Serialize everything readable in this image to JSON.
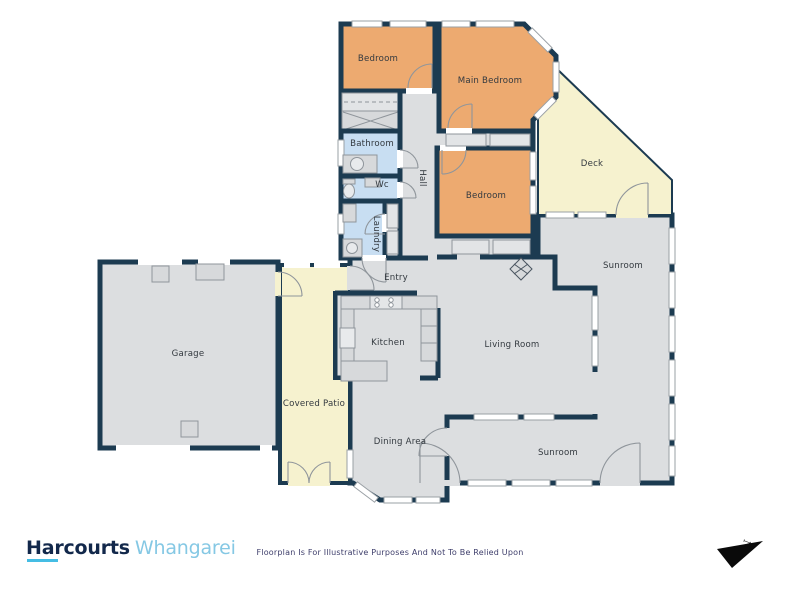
{
  "branding": {
    "brand": "Harcourts",
    "office": "Whangarei",
    "brand_color": "#12284b",
    "office_color": "#85c8e4",
    "underline_color": "#45bde4"
  },
  "disclaimer": "Floorplan Is For Illustrative Purposes And Not To Be Relied Upon",
  "compass": {
    "label": "N"
  },
  "colors": {
    "wall": "#1c3b51",
    "room_gray": "#dcdee0",
    "bedroom_orange": "#edaa70",
    "wet_area_blue": "#c8def2",
    "outdoor_yellow": "#f6f2cf",
    "fixture_gray": "#d7d9db",
    "label_text": "#33393f"
  },
  "floorplan": {
    "rooms": [
      {
        "label": "Bedroom"
      },
      {
        "label": "Main Bedroom"
      },
      {
        "label": "Bathroom"
      },
      {
        "label": "Wc"
      },
      {
        "label": "Laundry"
      },
      {
        "label": "Hall"
      },
      {
        "label": "Bedroom"
      },
      {
        "label": "Deck"
      },
      {
        "label": "Entry"
      },
      {
        "label": "Sunroom"
      },
      {
        "label": "Garage"
      },
      {
        "label": "Kitchen"
      },
      {
        "label": "Living Room"
      },
      {
        "label": "Covered Patio"
      },
      {
        "label": "Dining Area"
      },
      {
        "label": "Sunroom"
      }
    ]
  }
}
